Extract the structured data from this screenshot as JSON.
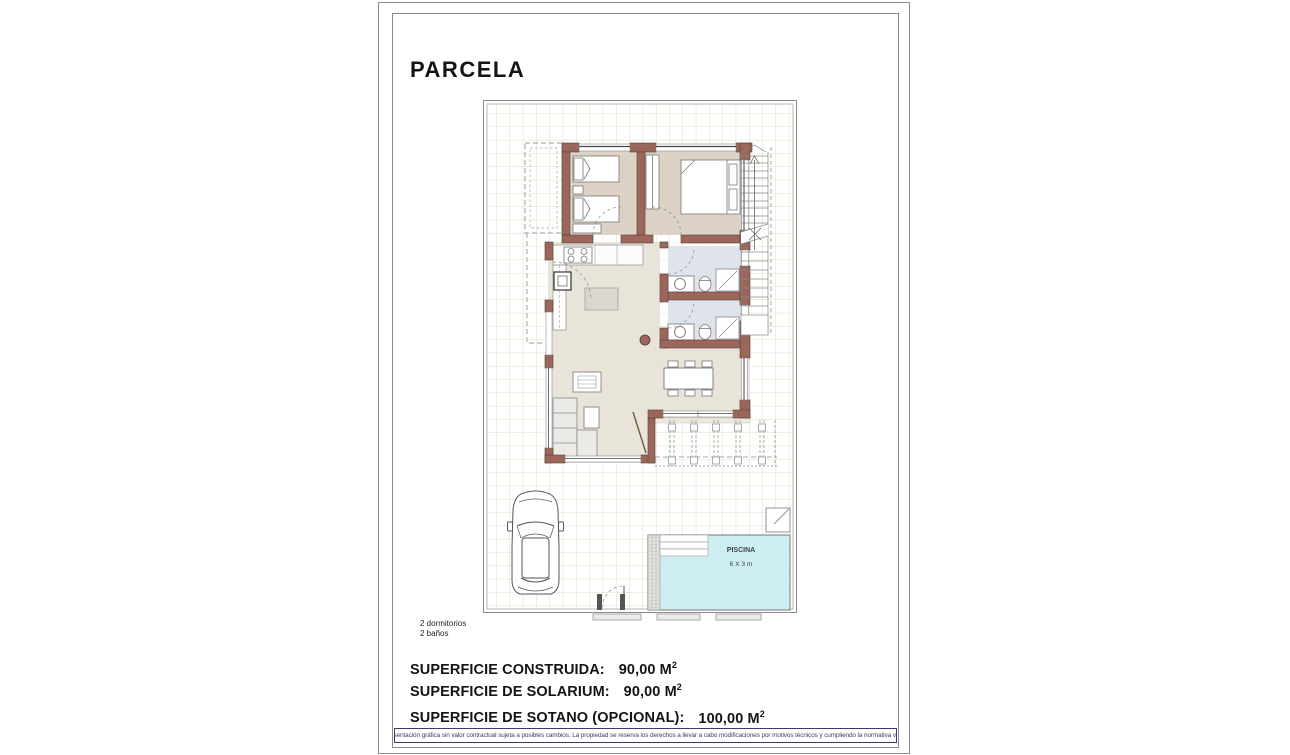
{
  "title": "PARCELA",
  "plan_notes": {
    "line1": "2 dormitorios",
    "line2": "2 baños"
  },
  "pool": {
    "label": "PISCINA",
    "size": "6 X 3 m"
  },
  "surfaces": [
    {
      "label": "SUPERFICIE CONSTRUIDA:",
      "value": "90,00 M",
      "sup": "2"
    },
    {
      "label": "SUPERFICIE DE SOLARIUM:",
      "value": "90,00 M",
      "sup": "2"
    },
    {
      "label": "SUPERFICIE DE SOTANO (OPCIONAL):",
      "value": "100,00 M",
      "sup": "2"
    }
  ],
  "disclaimer": "Representación gráfica sin valor contractual sujeta a posibles cambios. La propiedad se reserva los derechos a llevar a cabo modificaciones por motivos técnicos y cumpliendo la normativa vigente.",
  "colors": {
    "wall": "#9c675a",
    "wall_outline": "#53413a",
    "bedroom_floor": "#dcd2c6",
    "living_floor": "#e9e4da",
    "bath_floor": "#dfe3eb",
    "pool_water": "#cdeff2",
    "grid_line": "#d9d3b0",
    "disclaimer_text": "#3c3c64"
  }
}
